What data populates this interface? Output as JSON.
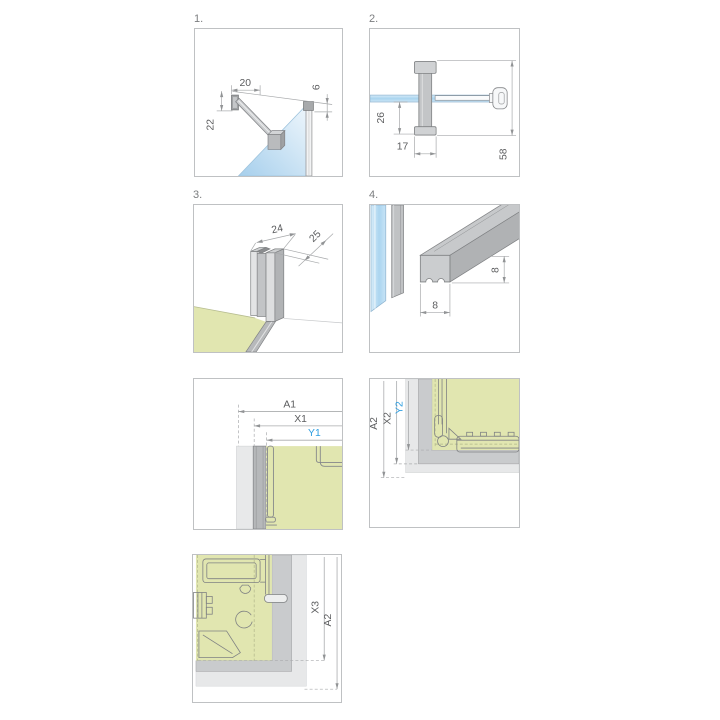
{
  "title": "Installation dimension diagrams",
  "colors": {
    "accent_blue": "#2f9fe1",
    "glass_blue": "#a9d4ef",
    "tray_green": "#e1e6b0",
    "profile_gray": "#c9cbcd",
    "profile_outline": "#7f8183",
    "dim_line": "#a6a8aa",
    "dim_text": "#5b5c5e"
  },
  "panels": {
    "p1": {
      "number": "1.",
      "dim_top_width": "20",
      "dim_left_height": "22",
      "dim_right_offset": "6"
    },
    "p2": {
      "number": "2.",
      "dim_glass_to_base": "26",
      "dim_base_width": "17",
      "dim_total_height": "58"
    },
    "p3": {
      "number": "3.",
      "dim_profile_width": "24",
      "dim_profile_depth": "25"
    },
    "p4": {
      "number": "4.",
      "dim_seal_width": "8",
      "dim_seal_height": "8"
    },
    "p5": {
      "dim_a": "A1",
      "dim_x": "X1",
      "dim_y": "Y1"
    },
    "p6": {
      "dim_a": "A2",
      "dim_x": "X2",
      "dim_y": "Y2"
    },
    "p7": {
      "dim_x": "X3",
      "dim_a": "A2"
    }
  }
}
